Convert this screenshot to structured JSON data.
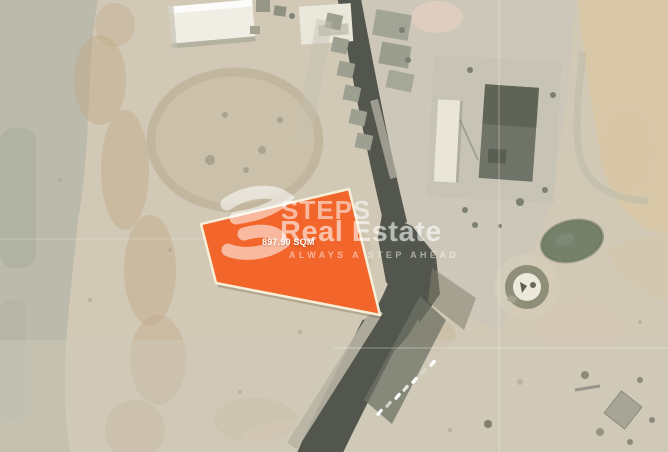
{
  "watermark": {
    "brand_top": "STEPS",
    "brand_bottom": "Real Estate",
    "tagline": "ALWAYS A STEP AHEAD",
    "logo_icon": "steps-s-swoosh-icon",
    "text_color": "rgba(255,255,255,0.55)"
  },
  "plot": {
    "area_label": "897.90 SQM",
    "polygon_points": "201,224 349,189 380,315 216,283",
    "fill_color": "#f2652b",
    "border_color": "#f8efd9"
  },
  "map": {
    "kind": "satellite-aerial-photo",
    "base_sand_color": "#d1c8b5",
    "beach_sand_color": "#d8c8a8",
    "road_color": "#52564c",
    "green_area_color": "#76816b",
    "building_white_color": "#f0eee4",
    "building_gray_color": "#9da091"
  }
}
